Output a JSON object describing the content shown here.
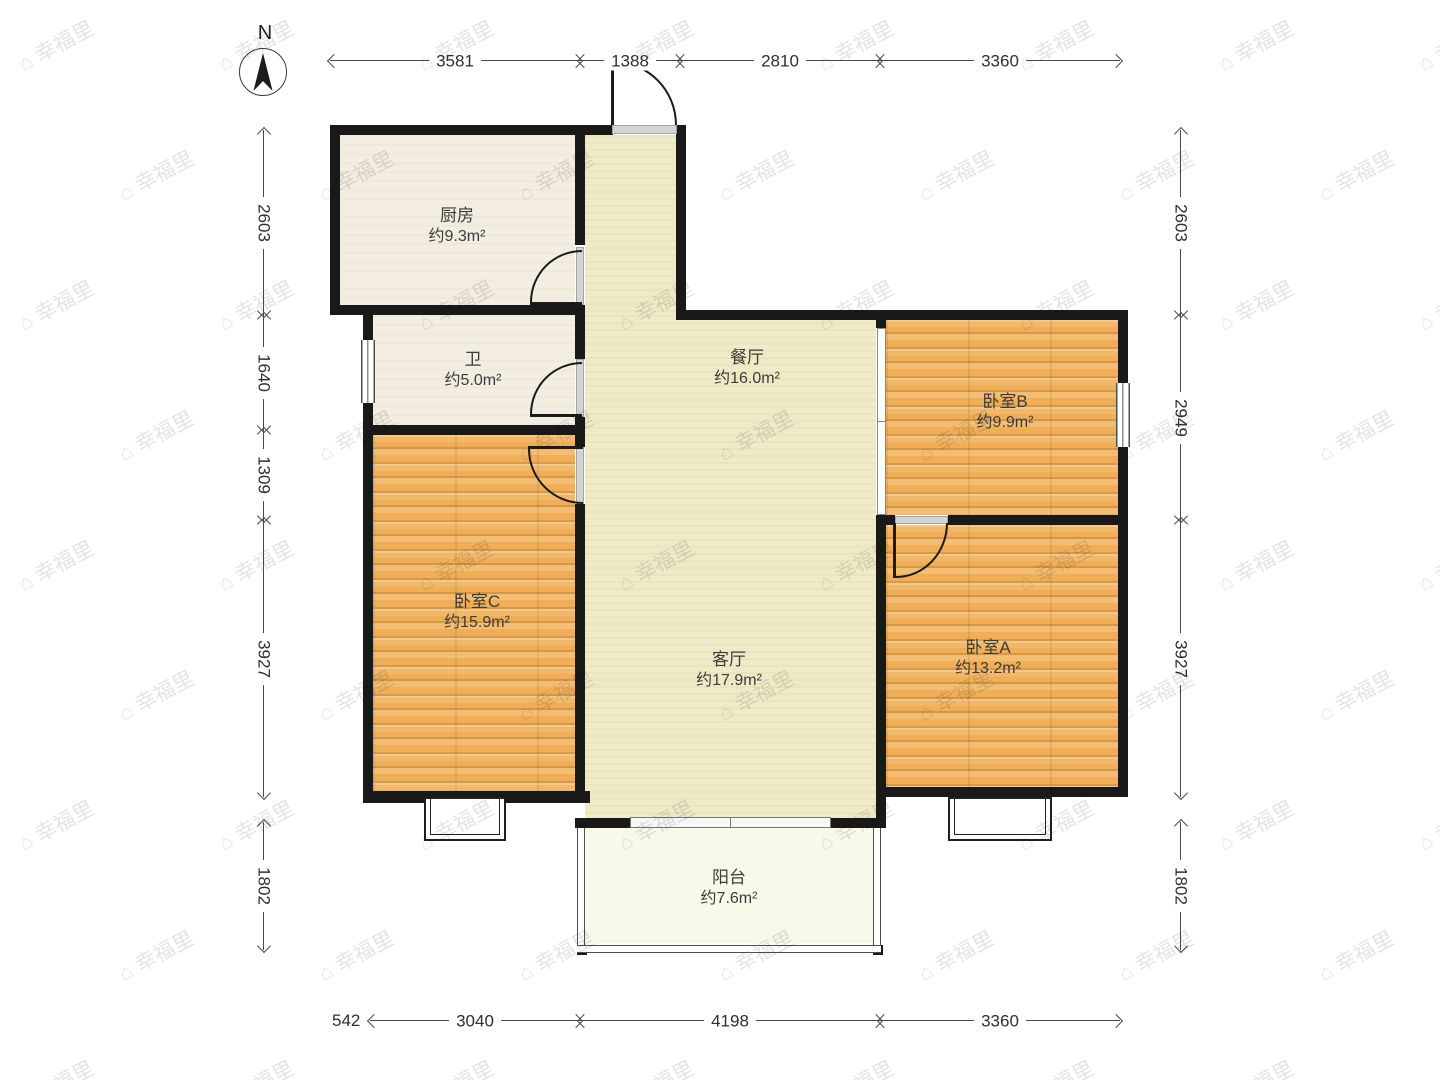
{
  "compass": {
    "north_label": "N"
  },
  "watermark": {
    "icon": "⌂",
    "text": "幸福里"
  },
  "rooms": {
    "kitchen": {
      "name": "厨房",
      "area": "约9.3m²"
    },
    "bathroom": {
      "name": "卫",
      "area": "约5.0m²"
    },
    "dining": {
      "name": "餐厅",
      "area": "约16.0m²"
    },
    "bedroomB": {
      "name": "卧室B",
      "area": "约9.9m²"
    },
    "bedroomC": {
      "name": "卧室C",
      "area": "约15.9m²"
    },
    "living": {
      "name": "客厅",
      "area": "约17.9m²"
    },
    "bedroomA": {
      "name": "卧室A",
      "area": "约13.2m²"
    },
    "balcony": {
      "name": "阳台",
      "area": "约7.6m²"
    }
  },
  "dimensions": {
    "top": [
      "3581",
      "1388",
      "2810",
      "3360"
    ],
    "bottom": [
      "542",
      "3040",
      "4198",
      "3360"
    ],
    "left": [
      "2603",
      "1640",
      "1309",
      "3927",
      "1802"
    ],
    "right": [
      "2603",
      "2949",
      "3927",
      "1802"
    ]
  },
  "colors": {
    "wall": "#191919",
    "wood_floor": "#efae57",
    "hall_floor": "#efebc9",
    "tile_floor": "#f3eee2",
    "balcony_floor": "#f9f9e9",
    "dimension_text": "#2f2f2f"
  }
}
